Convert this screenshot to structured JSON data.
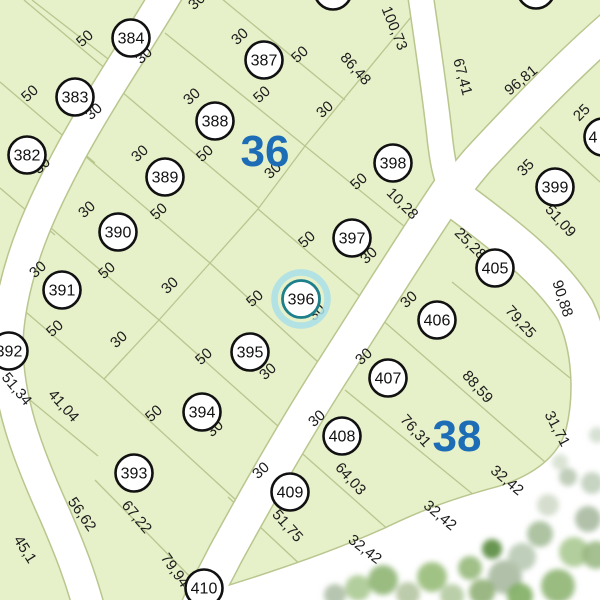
{
  "map": {
    "background_color": "#e6f0c9",
    "road_color": "#ffffff",
    "line_color": "#b9c68e",
    "block_label_color": "#1d6db6",
    "highlight_stroke_color": "#1e7f8c",
    "highlight_halo_color": "#a8dfe8",
    "blocks": [
      {
        "label": "36",
        "x": 265,
        "y": 150
      },
      {
        "label": "38",
        "x": 457,
        "y": 435
      }
    ],
    "lots": [
      {
        "num": "382",
        "x": 27,
        "y": 155,
        "highlighted": false
      },
      {
        "num": "383",
        "x": 75,
        "y": 97,
        "highlighted": false
      },
      {
        "num": "384",
        "x": 131,
        "y": 38,
        "highlighted": false
      },
      {
        "num": "387",
        "x": 264,
        "y": 60,
        "highlighted": false
      },
      {
        "num": "388",
        "x": 215,
        "y": 121,
        "highlighted": false
      },
      {
        "num": "389",
        "x": 165,
        "y": 177,
        "highlighted": false
      },
      {
        "num": "390",
        "x": 118,
        "y": 232,
        "highlighted": false
      },
      {
        "num": "391",
        "x": 62,
        "y": 290,
        "highlighted": false
      },
      {
        "num": "392",
        "x": 9,
        "y": 351,
        "highlighted": false
      },
      {
        "num": "393",
        "x": 134,
        "y": 473,
        "highlighted": false
      },
      {
        "num": "394",
        "x": 202,
        "y": 412,
        "highlighted": false
      },
      {
        "num": "395",
        "x": 250,
        "y": 352,
        "highlighted": false
      },
      {
        "num": "396",
        "x": 301,
        "y": 299,
        "highlighted": true
      },
      {
        "num": "397",
        "x": 352,
        "y": 238,
        "highlighted": false
      },
      {
        "num": "398",
        "x": 393,
        "y": 163,
        "highlighted": false
      },
      {
        "num": "399",
        "x": 555,
        "y": 187,
        "highlighted": false
      },
      {
        "num": "405",
        "x": 495,
        "y": 268,
        "highlighted": false
      },
      {
        "num": "406",
        "x": 437,
        "y": 320,
        "highlighted": false
      },
      {
        "num": "407",
        "x": 388,
        "y": 378,
        "highlighted": false
      },
      {
        "num": "408",
        "x": 342,
        "y": 436,
        "highlighted": false
      },
      {
        "num": "409",
        "x": 290,
        "y": 492,
        "highlighted": false
      },
      {
        "num": "410",
        "x": 204,
        "y": 588,
        "highlighted": false
      }
    ],
    "partial_lots": [
      {
        "num": "",
        "x": 333,
        "y": -9,
        "tx": 0
      },
      {
        "num": "",
        "x": 536,
        "y": -10,
        "tx": 0
      },
      {
        "num": "4",
        "x": 603,
        "y": 137,
        "tx": -10
      }
    ],
    "dimensions": [
      {
        "text": "50",
        "x": -6,
        "y": 27,
        "rot": -50
      },
      {
        "text": "30",
        "x": 200,
        "y": 5,
        "rot": -42
      },
      {
        "text": "50",
        "x": 88,
        "y": 42,
        "rot": -42
      },
      {
        "text": "30",
        "x": 147,
        "y": 59,
        "rot": -42
      },
      {
        "text": "50",
        "x": 33,
        "y": 97,
        "rot": -42
      },
      {
        "text": "30",
        "x": 97,
        "y": 115,
        "rot": -42
      },
      {
        "text": "30",
        "x": 45,
        "y": 169,
        "rot": -42
      },
      {
        "text": "30",
        "x": 243,
        "y": 40,
        "rot": -42
      },
      {
        "text": "50",
        "x": 303,
        "y": 58,
        "rot": -42
      },
      {
        "text": "86,48",
        "x": 352,
        "y": 72,
        "rot": 48
      },
      {
        "text": "100,73",
        "x": 390,
        "y": 30,
        "rot": 68
      },
      {
        "text": "67,41",
        "x": 458,
        "y": 78,
        "rot": 75
      },
      {
        "text": "96,81",
        "x": 524,
        "y": 84,
        "rot": -40
      },
      {
        "text": "30",
        "x": 195,
        "y": 100,
        "rot": -42
      },
      {
        "text": "50",
        "x": 265,
        "y": 98,
        "rot": -42
      },
      {
        "text": "30",
        "x": 328,
        "y": 113,
        "rot": -42
      },
      {
        "text": "50",
        "x": 362,
        "y": 185,
        "rot": -42
      },
      {
        "text": "10,28",
        "x": 399,
        "y": 207,
        "rot": 45
      },
      {
        "text": "30",
        "x": 143,
        "y": 157,
        "rot": -42
      },
      {
        "text": "50",
        "x": 208,
        "y": 157,
        "rot": -42
      },
      {
        "text": "30",
        "x": 276,
        "y": 174,
        "rot": -42
      },
      {
        "text": "30",
        "x": 90,
        "y": 213,
        "rot": -42
      },
      {
        "text": "50",
        "x": 162,
        "y": 215,
        "rot": -42
      },
      {
        "text": "30",
        "x": 41,
        "y": 273,
        "rot": -42
      },
      {
        "text": "50",
        "x": 110,
        "y": 274,
        "rot": -42
      },
      {
        "text": "30",
        "x": 173,
        "y": 289,
        "rot": -42
      },
      {
        "text": "50",
        "x": 58,
        "y": 332,
        "rot": -42
      },
      {
        "text": "30",
        "x": 122,
        "y": 343,
        "rot": -42
      },
      {
        "text": "51,34",
        "x": 13,
        "y": 392,
        "rot": 50
      },
      {
        "text": "41,04",
        "x": 60,
        "y": 409,
        "rot": 48
      },
      {
        "text": "50",
        "x": 310,
        "y": 243,
        "rot": -42
      },
      {
        "text": "30",
        "x": 372,
        "y": 259,
        "rot": -42
      },
      {
        "text": "50",
        "x": 258,
        "y": 302,
        "rot": -42
      },
      {
        "text": "30",
        "x": 320,
        "y": 316,
        "rot": -42
      },
      {
        "text": "50",
        "x": 207,
        "y": 360,
        "rot": -42
      },
      {
        "text": "30",
        "x": 271,
        "y": 375,
        "rot": -42
      },
      {
        "text": "50",
        "x": 157,
        "y": 417,
        "rot": -42
      },
      {
        "text": "30",
        "x": 218,
        "y": 432,
        "rot": -42
      },
      {
        "text": "56,62",
        "x": 78,
        "y": 517,
        "rot": 55
      },
      {
        "text": "67,22",
        "x": 133,
        "y": 520,
        "rot": 50
      },
      {
        "text": "45,1",
        "x": 21,
        "y": 552,
        "rot": 58
      },
      {
        "text": "79,94",
        "x": 171,
        "y": 573,
        "rot": 55
      },
      {
        "text": "25",
        "x": 585,
        "y": 116,
        "rot": -45
      },
      {
        "text": "35",
        "x": 529,
        "y": 171,
        "rot": -45
      },
      {
        "text": "51,09",
        "x": 557,
        "y": 224,
        "rot": 48
      },
      {
        "text": "25,28",
        "x": 467,
        "y": 247,
        "rot": 45
      },
      {
        "text": "90,88",
        "x": 558,
        "y": 300,
        "rot": 72
      },
      {
        "text": "30",
        "x": 412,
        "y": 303,
        "rot": -42
      },
      {
        "text": "79,25",
        "x": 517,
        "y": 325,
        "rot": 48
      },
      {
        "text": "30",
        "x": 367,
        "y": 360,
        "rot": -42
      },
      {
        "text": "88,59",
        "x": 474,
        "y": 390,
        "rot": 48
      },
      {
        "text": "30",
        "x": 320,
        "y": 422,
        "rot": -42
      },
      {
        "text": "76,31",
        "x": 412,
        "y": 434,
        "rot": 48
      },
      {
        "text": "31,71",
        "x": 553,
        "y": 431,
        "rot": 62
      },
      {
        "text": "30",
        "x": 264,
        "y": 474,
        "rot": -42
      },
      {
        "text": "64,03",
        "x": 347,
        "y": 482,
        "rot": 48
      },
      {
        "text": "51,75",
        "x": 284,
        "y": 529,
        "rot": 48
      },
      {
        "text": "32,42",
        "x": 504,
        "y": 484,
        "rot": 40
      },
      {
        "text": "32,42",
        "x": 437,
        "y": 519,
        "rot": 40
      },
      {
        "text": "32,42",
        "x": 362,
        "y": 553,
        "rot": 38
      }
    ]
  }
}
